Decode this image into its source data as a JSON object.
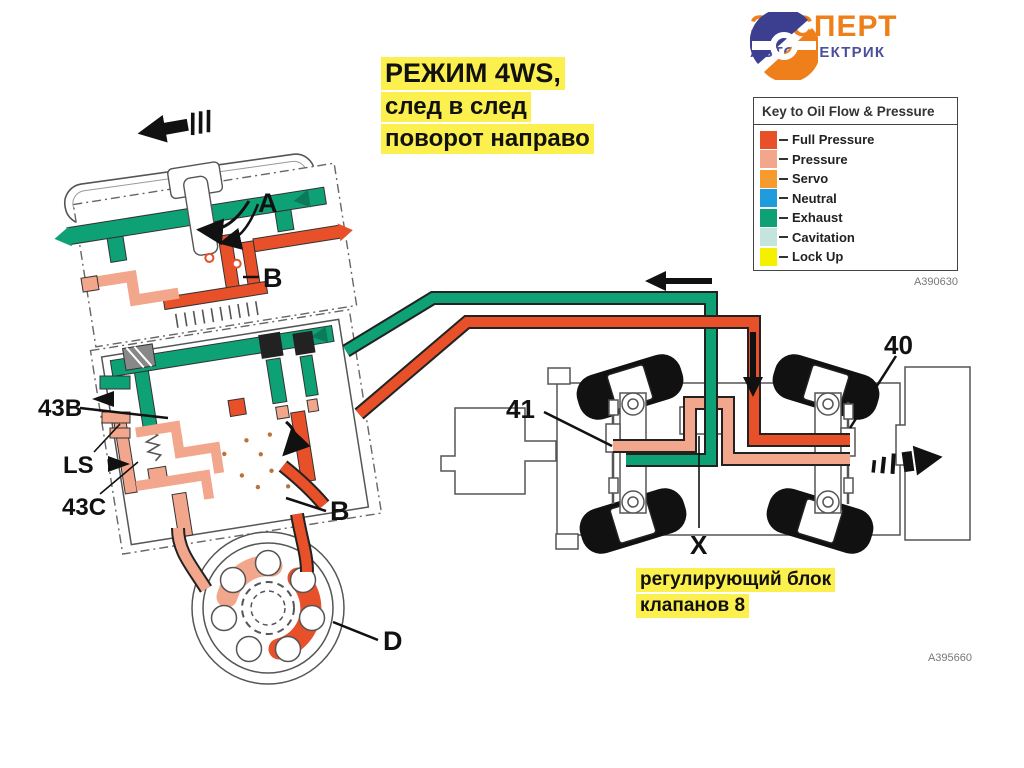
{
  "logo": {
    "name": "ЭКСПЕРТ",
    "subname": "АВТОЭЛЕКТРИК"
  },
  "title": {
    "line1": "РЕЖИМ 4WS,",
    "line2": "след в след",
    "line3": "поворот направо"
  },
  "legend": {
    "header": "Key to Oil Flow & Pressure",
    "code": "A390630",
    "items": [
      {
        "label": "Full Pressure",
        "color": "#E8502A"
      },
      {
        "label": "Pressure",
        "color": "#F2A68C"
      },
      {
        "label": "Servo",
        "color": "#F79B31"
      },
      {
        "label": "Neutral",
        "color": "#1F9CDC"
      },
      {
        "label": "Exhaust",
        "color": "#0FA176"
      },
      {
        "label": "Cavitation",
        "color": "#C4E4DC"
      },
      {
        "label": "Lock Up",
        "color": "#F5F000"
      }
    ]
  },
  "caption": {
    "line1": "регулирующий блок",
    "line2": "клапанов 8"
  },
  "figure_code": "A395660",
  "diagram": {
    "labels": {
      "a": "A",
      "b_upper": "B",
      "v43b": "43B",
      "ls": "LS",
      "v43c": "43C",
      "b_lower": "B",
      "d": "D",
      "n41": "41",
      "n40": "40",
      "x": "X"
    },
    "colors": {
      "full_pressure": "#E8502A",
      "pressure": "#F2A68C",
      "exhaust": "#0FA176"
    }
  }
}
